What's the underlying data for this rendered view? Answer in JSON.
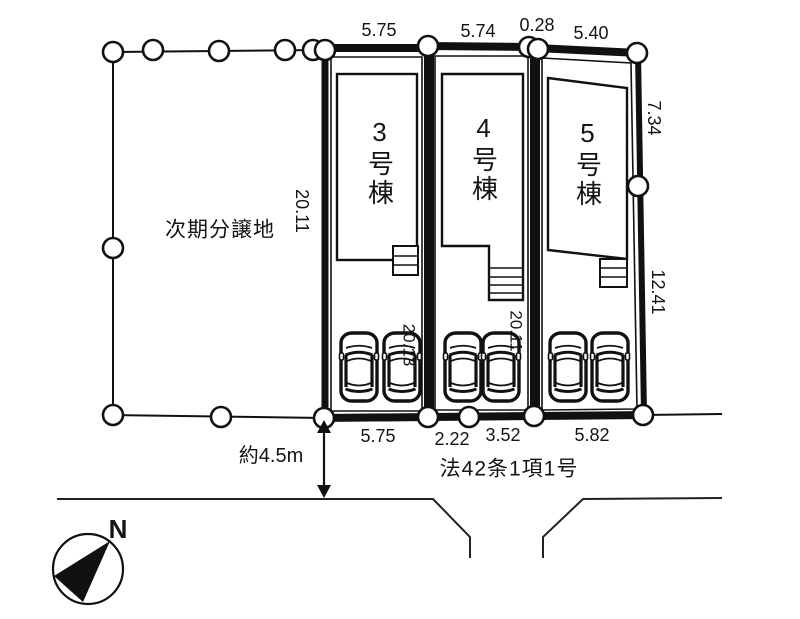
{
  "diagram": {
    "area_label": "次期分譲地",
    "road_label": "法42条1項1号",
    "road_width_label": "約4.5m",
    "north_label": "N",
    "buildings": [
      {
        "label": "3号棟"
      },
      {
        "label": "4号棟"
      },
      {
        "label": "5号棟"
      }
    ],
    "dims": {
      "top_lot3": "5.75",
      "top_lot4": "5.74",
      "top_jog": "0.28",
      "top_lot5": "5.40",
      "right_upper": "7.34",
      "right_lower": "12.41",
      "left_lot3": "20.11",
      "inner_lot3": "20.13",
      "inner_lot4": "20.11",
      "bottom_lot3": "5.75",
      "bottom_lot4_left": "2.22",
      "bottom_lot4_right": "3.52",
      "bottom_lot5": "5.82"
    }
  }
}
